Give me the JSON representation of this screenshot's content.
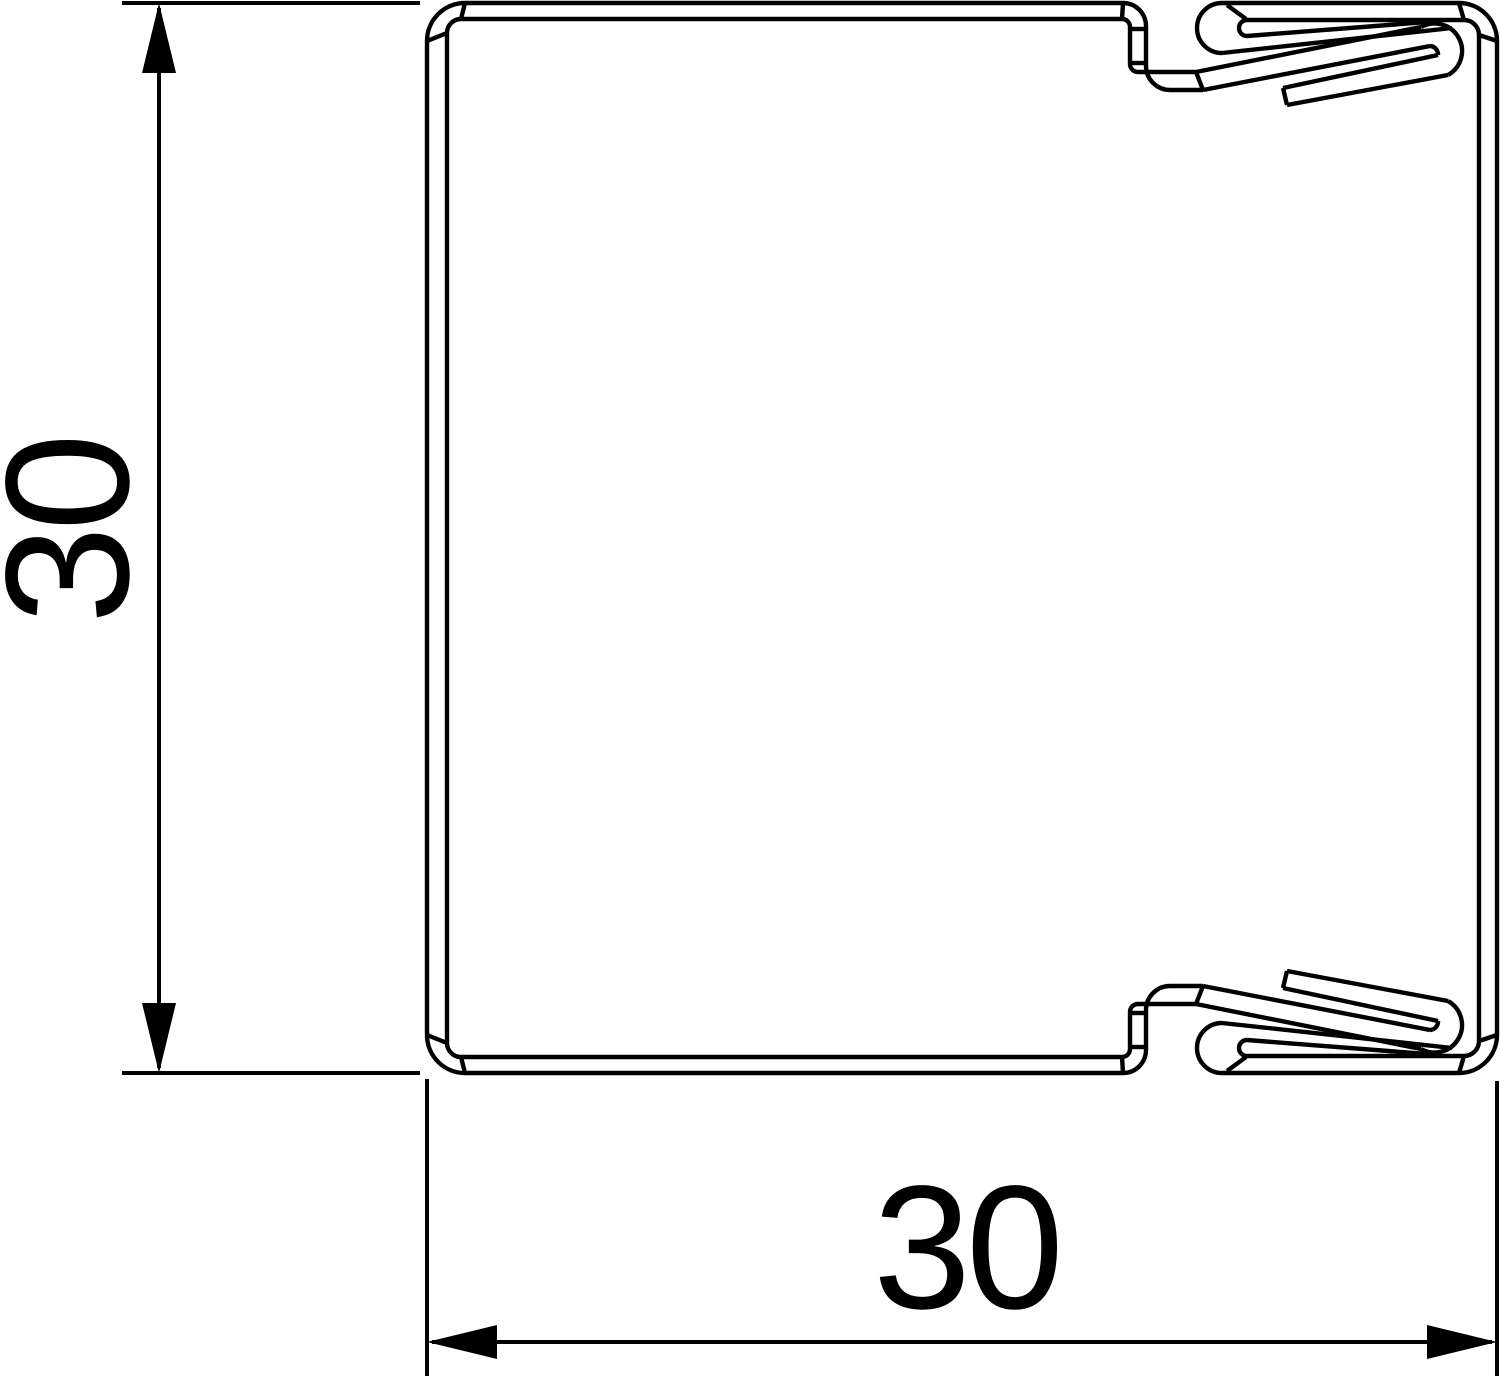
{
  "page": {
    "background": "#ffffff"
  },
  "drawing": {
    "kind": "technical-cross-section",
    "line_color": "#000000",
    "arrow_color": "#000000",
    "dimensions": {
      "height": {
        "value": "30",
        "orientation": "vertical"
      },
      "width": {
        "value": "30",
        "orientation": "horizontal"
      }
    }
  }
}
